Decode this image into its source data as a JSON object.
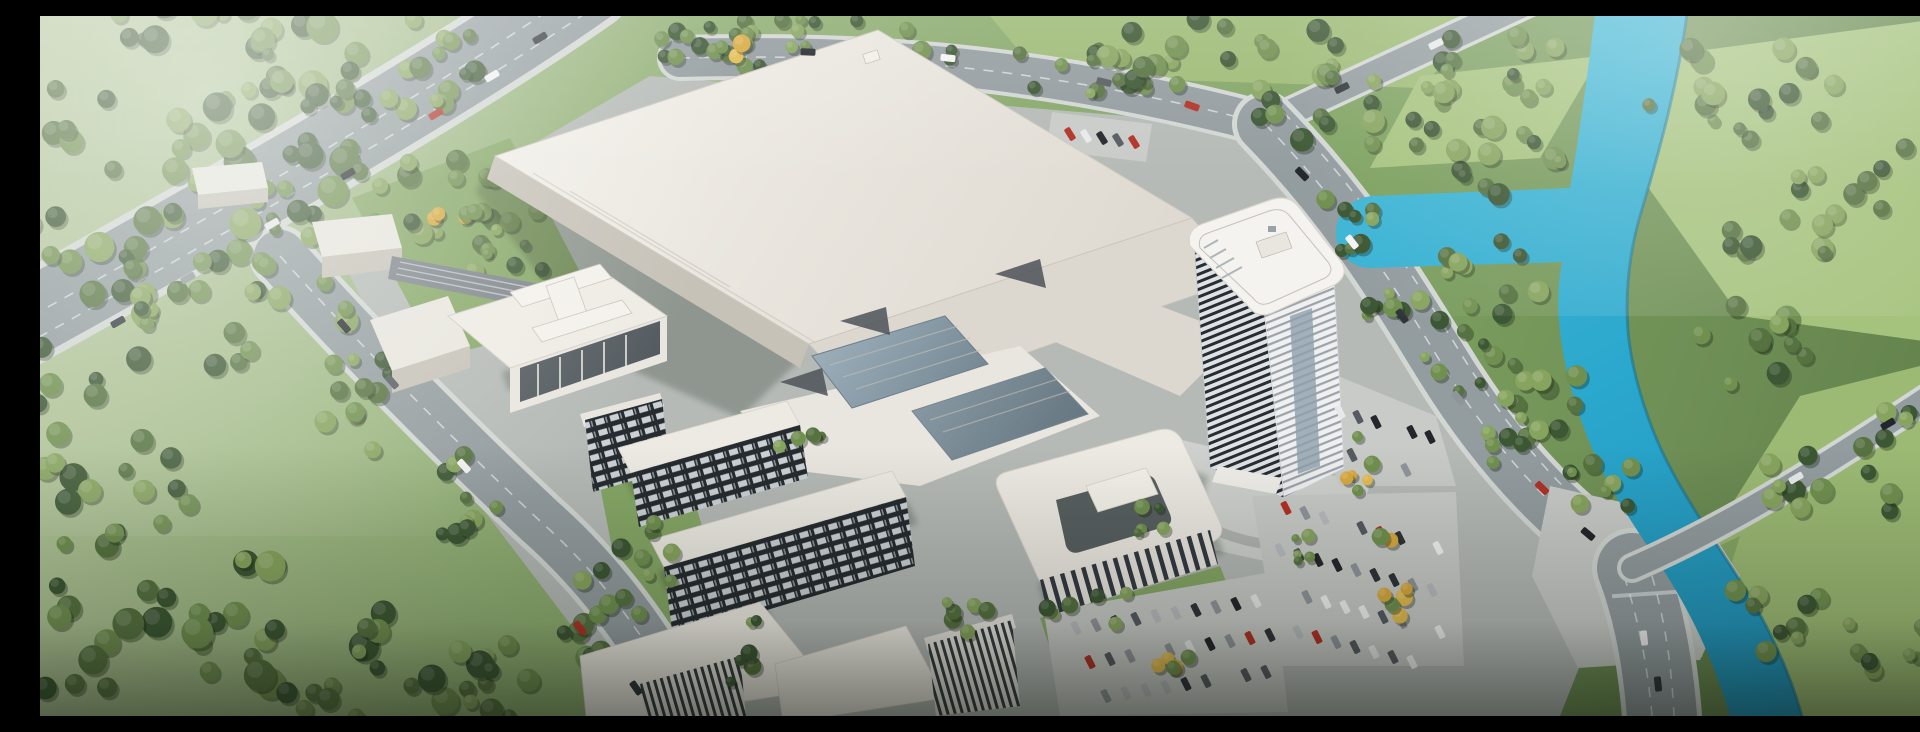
{
  "meta": {
    "kind": "architectural-aerial-rendering",
    "description": "Bird's-eye rendering of a large industrial campus: one huge white factory hall, a curved high-rise office tower, dormitory slabs with dark window grids, a courtyard office podium, tree-lined boulevards, large parking lots with autumn-yellow trees, an elevated highway at top-left and a turquoise river winding through forest and meadows on the right.",
    "width": 1920,
    "height": 700
  },
  "palette": {
    "grass_top": "#b9c9a2",
    "grass_mid": "#8fae72",
    "grass_deep": "#5e7c49",
    "field": "#9cba74",
    "field_bright": "#a6c37e",
    "verge": "#86a766",
    "tree_dark": "#3c5733",
    "tree_mid": "#567240",
    "tree_light": "#70904f",
    "tree_pale": "#87a45e",
    "tree_yellow": "#e3bc4e",
    "tree_yellow2": "#d9a93f",
    "tree_shadow": "rgba(25,38,20,0.35)",
    "water": "#2aa7cd",
    "water_light": "#49bcd9",
    "water_edge": "#17708f",
    "pavement": "#b5bab7",
    "pavement_light": "#c8cbc7",
    "plaza": "#ced1cd",
    "road": "#939c9f",
    "road_edge": "#d3d7d4",
    "roof": "#efece5",
    "roof_shade": "#ddd8cf",
    "facade": "#c7c2b8",
    "facade_light": "#e9e6df",
    "glass_dark": "#39424a",
    "glass_blue_1": "#9fb2bd",
    "glass_blue_2": "#5d707c",
    "wedge": "#4c5258",
    "grid_bg": "#262b30",
    "grid_win": "#ccd1d5",
    "stripe_dark": "#343b42",
    "tower_bgA": "#dfe3e5",
    "tower_line": "#272d33",
    "tower_bgB": "#eef0f1",
    "tower_lineB": "#5a626a",
    "hq_bar": "#323a43",
    "car_red": "#b23125",
    "haze": "#f4f7f2",
    "vignette": "#0a0e07"
  },
  "scene": {
    "tree_tones": {
      "green": [
        "#3c5733",
        "#567240",
        "#70904f",
        "#87a45e"
      ],
      "yellow": [
        "#e3bc4e",
        "#d9a93f",
        "#70904f"
      ]
    },
    "car_colors": [
      "#23272b",
      "#f2f3f3",
      "#b8bcc0",
      "#b23125",
      "#2f343a",
      "#e8e9ea",
      "#555b61",
      "#8f969b"
    ],
    "tree_clusters": [
      {
        "x": 115,
        "y": 115,
        "rx": 235,
        "ry": 150,
        "n": 64,
        "tone": "green",
        "s": [
          7,
          16
        ]
      },
      {
        "x": 330,
        "y": 45,
        "rx": 150,
        "ry": 55,
        "n": 26,
        "tone": "green",
        "s": [
          6,
          13
        ]
      },
      {
        "x": 25,
        "y": 300,
        "rx": 95,
        "ry": 85,
        "n": 18,
        "tone": "green",
        "s": [
          7,
          14
        ]
      },
      {
        "x": 365,
        "y": 195,
        "rx": 140,
        "ry": 55,
        "n": 22,
        "tone": "green",
        "s": [
          6,
          12
        ]
      },
      {
        "x": 205,
        "y": 298,
        "rx": 115,
        "ry": 60,
        "n": 18,
        "tone": "green",
        "s": [
          6,
          12
        ]
      },
      {
        "x": 58,
        "y": 455,
        "rx": 105,
        "ry": 85,
        "n": 20,
        "tone": "green",
        "s": [
          7,
          14
        ]
      },
      {
        "x": 150,
        "y": 615,
        "rx": 215,
        "ry": 85,
        "n": 34,
        "tone": "green",
        "s": [
          8,
          16
        ]
      },
      {
        "x": 385,
        "y": 660,
        "rx": 150,
        "ry": 55,
        "n": 22,
        "tone": "green",
        "s": [
          7,
          14
        ]
      },
      {
        "x": 330,
        "y": 385,
        "rx": 55,
        "ry": 55,
        "n": 11,
        "tone": "green",
        "s": [
          6,
          11
        ]
      },
      {
        "x": 432,
        "y": 482,
        "rx": 55,
        "ry": 48,
        "n": 10,
        "tone": "green",
        "s": [
          6,
          11
        ]
      },
      {
        "x": 540,
        "y": 598,
        "rx": 65,
        "ry": 55,
        "n": 11,
        "tone": "green",
        "s": [
          6,
          12
        ]
      },
      {
        "x": 800,
        "y": 28,
        "rx": 225,
        "ry": 26,
        "n": 26,
        "tone": "green",
        "s": [
          5,
          10
        ]
      },
      {
        "x": 672,
        "y": 30,
        "rx": 55,
        "ry": 18,
        "n": 7,
        "tone": "yellow",
        "s": [
          5,
          9
        ]
      },
      {
        "x": 1062,
        "y": 58,
        "rx": 85,
        "ry": 28,
        "n": 12,
        "tone": "green",
        "s": [
          5,
          10
        ]
      },
      {
        "x": 1185,
        "y": 38,
        "rx": 135,
        "ry": 42,
        "n": 20,
        "tone": "green",
        "s": [
          6,
          12
        ]
      },
      {
        "x": 1330,
        "y": 92,
        "rx": 115,
        "ry": 42,
        "n": 17,
        "tone": "green",
        "s": [
          6,
          12
        ]
      },
      {
        "x": 1455,
        "y": 55,
        "rx": 85,
        "ry": 38,
        "n": 13,
        "tone": "green",
        "s": [
          6,
          12
        ]
      },
      {
        "x": 1468,
        "y": 140,
        "rx": 65,
        "ry": 48,
        "n": 12,
        "tone": "green",
        "s": [
          6,
          12
        ]
      },
      {
        "x": 1452,
        "y": 262,
        "rx": 55,
        "ry": 40,
        "n": 10,
        "tone": "green",
        "s": [
          6,
          11
        ]
      },
      {
        "x": 1502,
        "y": 382,
        "rx": 52,
        "ry": 42,
        "n": 10,
        "tone": "green",
        "s": [
          6,
          11
        ]
      },
      {
        "x": 1558,
        "y": 468,
        "rx": 42,
        "ry": 32,
        "n": 8,
        "tone": "green",
        "s": [
          5,
          10
        ]
      },
      {
        "x": 1700,
        "y": 78,
        "rx": 110,
        "ry": 52,
        "n": 17,
        "tone": "green",
        "s": [
          6,
          12
        ]
      },
      {
        "x": 1742,
        "y": 198,
        "rx": 80,
        "ry": 48,
        "n": 12,
        "tone": "green",
        "s": [
          6,
          12
        ]
      },
      {
        "x": 1702,
        "y": 328,
        "rx": 68,
        "ry": 44,
        "n": 11,
        "tone": "green",
        "s": [
          6,
          12
        ]
      },
      {
        "x": 1790,
        "y": 468,
        "rx": 78,
        "ry": 48,
        "n": 12,
        "tone": "green",
        "s": [
          6,
          12
        ]
      },
      {
        "x": 1728,
        "y": 598,
        "rx": 58,
        "ry": 38,
        "n": 9,
        "tone": "green",
        "s": [
          6,
          11
        ]
      },
      {
        "x": 1868,
        "y": 175,
        "rx": 55,
        "ry": 45,
        "n": 7,
        "tone": "green",
        "s": [
          6,
          11
        ]
      },
      {
        "x": 1882,
        "y": 420,
        "rx": 48,
        "ry": 38,
        "n": 6,
        "tone": "green",
        "s": [
          6,
          11
        ]
      },
      {
        "x": 1858,
        "y": 622,
        "rx": 65,
        "ry": 38,
        "n": 8,
        "tone": "green",
        "s": [
          6,
          11
        ]
      },
      {
        "x": 1418,
        "y": 330,
        "rx": 38,
        "ry": 48,
        "n": 8,
        "tone": "green",
        "s": [
          5,
          10
        ]
      },
      {
        "x": 1478,
        "y": 432,
        "rx": 38,
        "ry": 38,
        "n": 7,
        "tone": "green",
        "s": [
          5,
          10
        ]
      },
      {
        "x": 1298,
        "y": 208,
        "rx": 42,
        "ry": 32,
        "n": 8,
        "tone": "green",
        "s": [
          5,
          10
        ]
      },
      {
        "x": 1358,
        "y": 298,
        "rx": 38,
        "ry": 32,
        "n": 7,
        "tone": "green",
        "s": [
          5,
          10
        ]
      },
      {
        "x": 468,
        "y": 222,
        "rx": 65,
        "ry": 42,
        "n": 10,
        "tone": "green",
        "s": [
          5,
          10
        ]
      },
      {
        "x": 415,
        "y": 196,
        "rx": 30,
        "ry": 20,
        "n": 5,
        "tone": "yellow",
        "s": [
          5,
          9
        ]
      },
      {
        "x": 598,
        "y": 555,
        "rx": 42,
        "ry": 55,
        "n": 8,
        "tone": "green",
        "s": [
          5,
          10
        ],
        "layer": 2
      },
      {
        "x": 706,
        "y": 638,
        "rx": 36,
        "ry": 36,
        "n": 6,
        "tone": "green",
        "s": [
          5,
          10
        ],
        "layer": 2
      },
      {
        "x": 930,
        "y": 606,
        "rx": 42,
        "ry": 26,
        "n": 6,
        "tone": "green",
        "s": [
          5,
          9
        ],
        "layer": 2
      },
      {
        "x": 1052,
        "y": 592,
        "rx": 48,
        "ry": 22,
        "n": 6,
        "tone": "green",
        "s": [
          5,
          9
        ],
        "layer": 2
      },
      {
        "x": 762,
        "y": 428,
        "rx": 30,
        "ry": 26,
        "n": 5,
        "tone": "green",
        "s": [
          4,
          8
        ],
        "layer": 2
      },
      {
        "x": 1320,
        "y": 458,
        "rx": 20,
        "ry": 40,
        "n": 6,
        "tone": "yellow",
        "s": [
          5,
          9
        ],
        "layer": 2
      },
      {
        "x": 1348,
        "y": 560,
        "rx": 20,
        "ry": 52,
        "n": 7,
        "tone": "yellow",
        "s": [
          5,
          9
        ],
        "layer": 2
      },
      {
        "x": 1142,
        "y": 640,
        "rx": 40,
        "ry": 20,
        "n": 5,
        "tone": "yellow",
        "s": [
          5,
          9
        ],
        "layer": 2
      },
      {
        "x": 1258,
        "y": 528,
        "rx": 16,
        "ry": 40,
        "n": 5,
        "tone": "green",
        "s": [
          4,
          8
        ],
        "layer": 2
      },
      {
        "x": 1102,
        "y": 500,
        "rx": 30,
        "ry": 20,
        "n": 5,
        "tone": "green",
        "s": [
          4,
          8
        ],
        "layer": 2
      }
    ],
    "parking_rows": [
      {
        "x": 1300,
        "y": 396,
        "n": 6,
        "dx": 18,
        "dy": 5,
        "a": 63
      },
      {
        "x": 1294,
        "y": 434,
        "n": 6,
        "dx": 18,
        "dy": 5,
        "a": 63
      },
      {
        "x": 1246,
        "y": 492,
        "n": 9,
        "dx": 19,
        "dy": 5,
        "a": 63
      },
      {
        "x": 1240,
        "y": 534,
        "n": 9,
        "dx": 19,
        "dy": 5,
        "a": 63
      },
      {
        "x": 1248,
        "y": 576,
        "n": 9,
        "dx": 19,
        "dy": 5,
        "a": 63
      },
      {
        "x": 1258,
        "y": 616,
        "n": 8,
        "dx": 19,
        "dy": 5,
        "a": 63
      },
      {
        "x": 1036,
        "y": 612,
        "n": 10,
        "dx": 20,
        "dy": -3,
        "a": 63
      },
      {
        "x": 1050,
        "y": 646,
        "n": 10,
        "dx": 20,
        "dy": -3,
        "a": 63
      },
      {
        "x": 1066,
        "y": 680,
        "n": 9,
        "dx": 20,
        "dy": -3,
        "a": 63
      },
      {
        "x": 1030,
        "y": 118,
        "n": 5,
        "dx": 16,
        "dy": 2,
        "a": 58
      }
    ],
    "traffic": [
      {
        "x": 500,
        "y": 22,
        "a": -31,
        "c": "#2f343a"
      },
      {
        "x": 452,
        "y": 60,
        "a": -31,
        "c": "#f2f3f3"
      },
      {
        "x": 396,
        "y": 98,
        "a": -31,
        "c": "#b23125"
      },
      {
        "x": 308,
        "y": 158,
        "a": -30,
        "c": "#23272b"
      },
      {
        "x": 232,
        "y": 208,
        "a": -30,
        "c": "#e8e9ea"
      },
      {
        "x": 148,
        "y": 262,
        "a": -29,
        "c": "#8f969b"
      },
      {
        "x": 78,
        "y": 306,
        "a": -29,
        "c": "#2f343a"
      },
      {
        "x": 304,
        "y": 310,
        "a": 49,
        "c": "#23272b"
      },
      {
        "x": 352,
        "y": 366,
        "a": 49,
        "c": "#555b61"
      },
      {
        "x": 424,
        "y": 450,
        "a": 48,
        "c": "#f2f3f3"
      },
      {
        "x": 540,
        "y": 612,
        "a": 52,
        "c": "#b23125"
      },
      {
        "x": 596,
        "y": 672,
        "a": 55,
        "c": "#2f343a"
      },
      {
        "x": 768,
        "y": 36,
        "a": 2,
        "c": "#23272b"
      },
      {
        "x": 908,
        "y": 42,
        "a": 6,
        "c": "#f2f3f3"
      },
      {
        "x": 1064,
        "y": 66,
        "a": 14,
        "c": "#555b61"
      },
      {
        "x": 1152,
        "y": 90,
        "a": 20,
        "c": "#b23125"
      },
      {
        "x": 1302,
        "y": 72,
        "a": -26,
        "c": "#2f343a"
      },
      {
        "x": 1396,
        "y": 28,
        "a": -26,
        "c": "#e8e9ea"
      },
      {
        "x": 1262,
        "y": 158,
        "a": 46,
        "c": "#23272b"
      },
      {
        "x": 1312,
        "y": 226,
        "a": 52,
        "c": "#f2f3f3"
      },
      {
        "x": 1362,
        "y": 300,
        "a": 55,
        "c": "#2f343a"
      },
      {
        "x": 1418,
        "y": 382,
        "a": 51,
        "c": "#8f969b"
      },
      {
        "x": 1502,
        "y": 472,
        "a": 44,
        "c": "#b23125"
      },
      {
        "x": 1548,
        "y": 518,
        "a": 40,
        "c": "#23272b"
      },
      {
        "x": 1604,
        "y": 622,
        "a": 84,
        "c": "#f2f3f3"
      },
      {
        "x": 1618,
        "y": 668,
        "a": 84,
        "c": "#2f343a"
      },
      {
        "x": 1756,
        "y": 462,
        "a": -30,
        "c": "#e8e9ea"
      },
      {
        "x": 1848,
        "y": 408,
        "a": -30,
        "c": "#23272b"
      }
    ]
  }
}
